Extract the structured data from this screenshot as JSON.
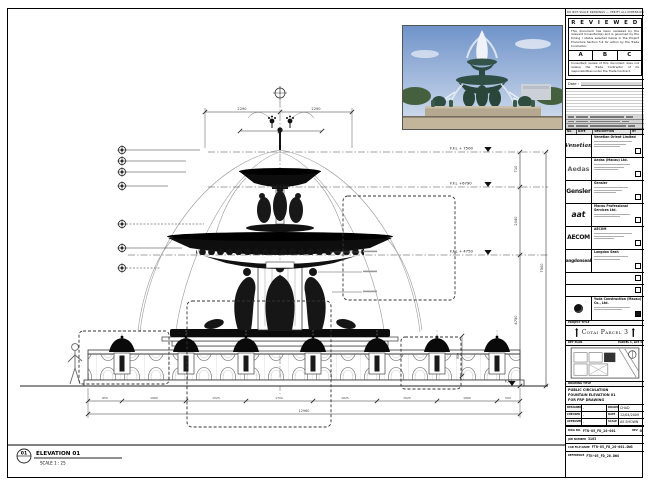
{
  "sheet": {
    "top_strip": "DO NOT SCALE DRAWINGS — VERIFY ALL DIMENSIONS ON SITE"
  },
  "stamp": {
    "title": "R E V I E W E D",
    "body": "This document has been reviewed by the relevant Consultant(s) and is governed by the timing / status selected below in the Project Procedure Section 5.4 for action by the Trade Contractor.",
    "options": [
      "A",
      "B",
      "C"
    ],
    "disclaimer": "Consultant review of this document does not relieve the Trade Contractor of its responsibilities under the Trade Contract.",
    "date_label": "Date :"
  },
  "revision_table": {
    "headers": [
      "NO.",
      "DATE",
      "DESCRIPTION",
      "BY"
    ]
  },
  "consultants": [
    {
      "logo": "Venetian",
      "name": "Venetian Orient Limited"
    },
    {
      "logo": "Aedas",
      "name": "Aedas (Macau) Ltd."
    },
    {
      "logo": "Gensler",
      "name": "Gensler"
    },
    {
      "logo": "aat",
      "name": "Macau Professional Services Ltd."
    },
    {
      "logo": "AECOM",
      "name": "AECOM"
    },
    {
      "logo": "langdonseah",
      "name": "Langdon Seah"
    }
  ],
  "contractor": {
    "name": "Yuda Construction (Macau) Co., Ltd."
  },
  "project": {
    "label": "PROJECT TITLE",
    "name": "Cotai Parcel 3"
  },
  "key_plan": {
    "label": "KEY PLAN",
    "caption": "PARCEL 1, LOT 3"
  },
  "title_block": {
    "drawing_title_label": "DRAWING TITLE",
    "title_line1": "PUBLIC CIRCULATION",
    "title_line2": "FOUNTAIN ELEVATION 01",
    "title_line3": "FOR FRP DRAWING",
    "designed_label": "DESIGNED",
    "designed": "-",
    "drawn_label": "DRAWN",
    "drawn": "CHAD",
    "checked_label": "CHECKED",
    "checked": "-",
    "date_label": "DATE",
    "date": "12/04/2009",
    "approved_label": "APPROVED",
    "approved": "-",
    "scale_label": "SCALE",
    "scale": "AS SHOWN",
    "dwg_no_label": "DWG NO.",
    "dwg_no": "FTN-05_FD_20-001",
    "rev_label": "REV",
    "rev": "0",
    "job_label": "JOB NUMBER",
    "job": "3103",
    "file_label": "CAD FILE NAME",
    "file": "FTN-05_FD_20-001.DWG",
    "ref_label": "REFERENCE",
    "ref": "FTN-05_FD_20.DWG"
  },
  "drawing": {
    "marker_number": "01",
    "elevation_label": "ELEVATION 01",
    "scale_label": "SCALE  1 : 25",
    "levels": {
      "l1": "F.F.L + 7500",
      "l2": "F.F.L +6790",
      "l3": "F.F.L + 4750",
      "l4": "F.F.L."
    },
    "dims": {
      "top_left": "2290",
      "top_right": "2290",
      "right_1": "710",
      "right_2": "2040",
      "right_3": "4750",
      "right_total": "7500",
      "b0": "850",
      "b1": "1660",
      "b2": "1525",
      "b3": "1700",
      "b4": "1625",
      "b5": "1525",
      "b6": "1660",
      "b7": "590",
      "bottom_total": "12960",
      "bollard_height": "900"
    }
  }
}
